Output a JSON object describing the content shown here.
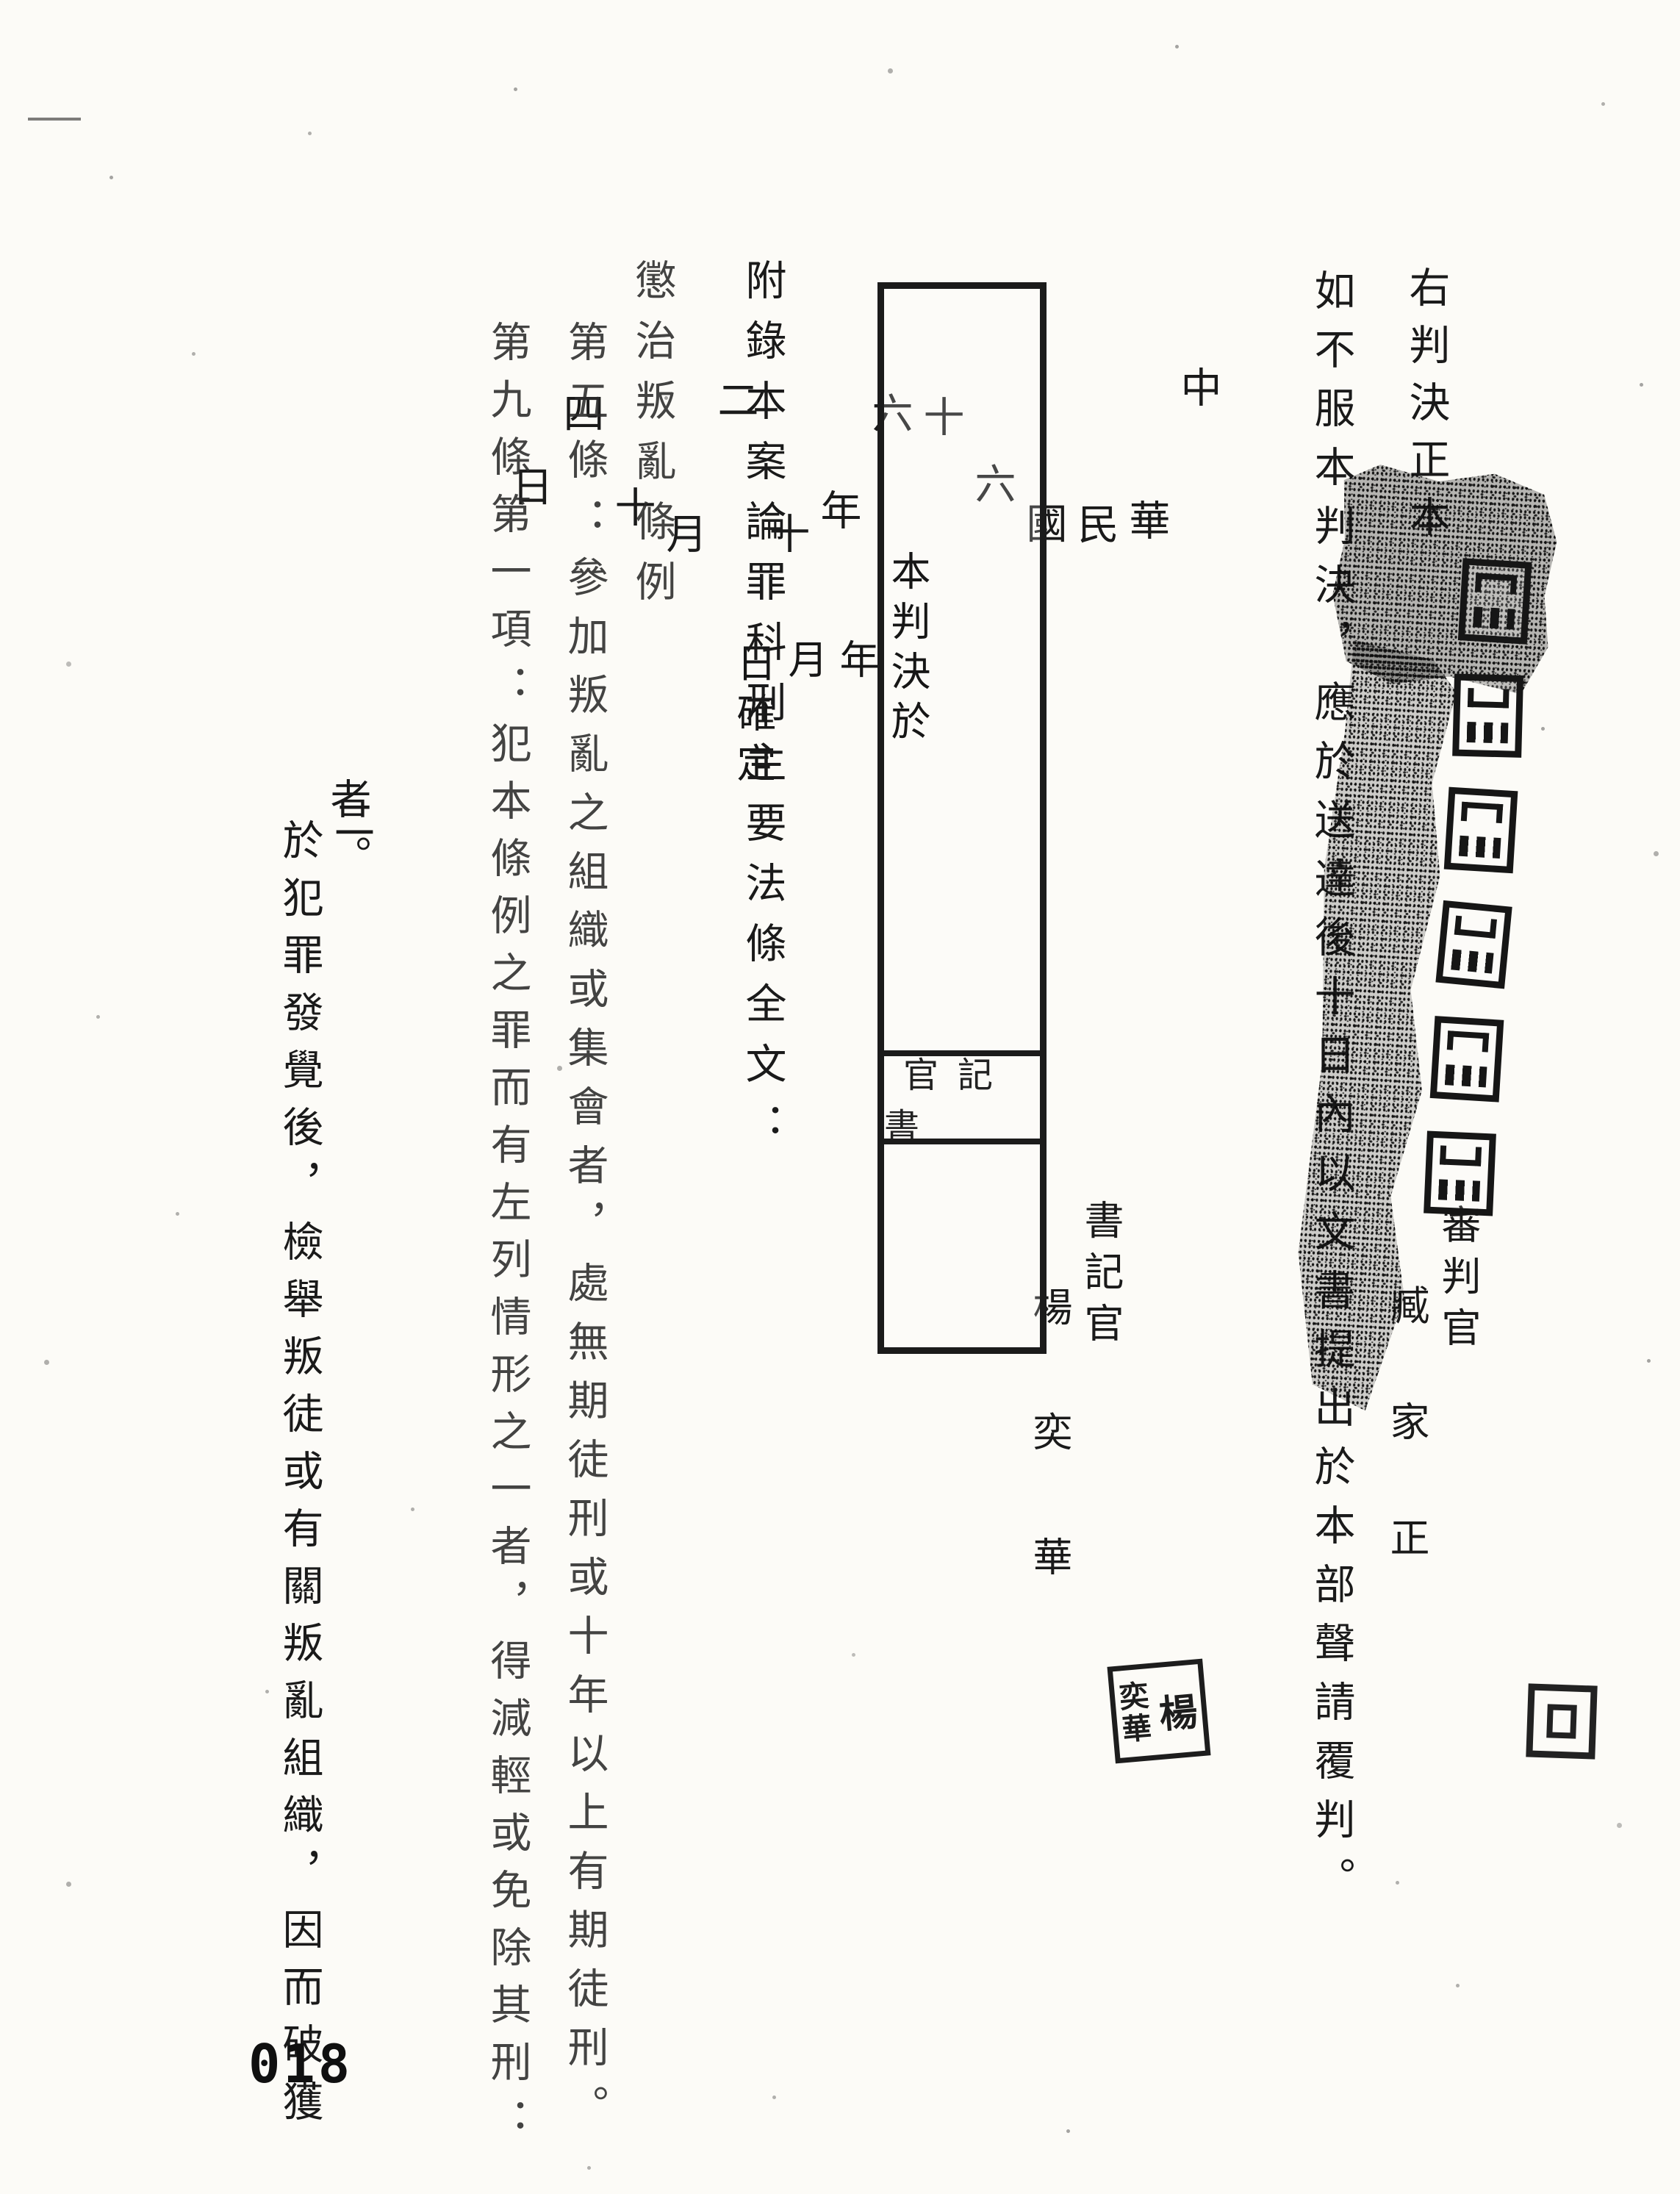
{
  "page": {
    "number": "018"
  },
  "closing": {
    "copy_note": "右判決正本",
    "appeal_notice": "如不服本判決，應於送達後十日內以文書提出於本部聲請覆判。",
    "date": {
      "parts": [
        "中",
        "華",
        "民",
        "國",
        "六",
        "十",
        "六",
        "年",
        "十",
        "二",
        "月",
        "十",
        "四",
        "日"
      ]
    },
    "judge": {
      "title": "審判官",
      "name": "臧家正"
    },
    "clerk": {
      "title": "書記官",
      "name": "楊奕華",
      "seal": {
        "right": "楊",
        "left_top": "奕",
        "left_bottom": "華"
      }
    }
  },
  "finality_box": {
    "line": {
      "prefix": "本判決於",
      "year": "年",
      "month": "月",
      "suffix": "日確定"
    },
    "clerk_label_rtl": "官記書"
  },
  "appendix": {
    "heading": "附錄本案論罪科刑主要法條全文：",
    "statute_title": "懲治叛亂條例",
    "article5": "第五條：參加叛亂之組織或集會者，處無期徒刑或十年以上有期徒刑。",
    "article9_intro": "第九條第一項：犯本條例之罪而有左列情形之一者，得減輕或免除其刑：",
    "item2": {
      "marker": "二",
      "text": "於犯罪發覺後，檢舉叛徒或有關叛亂組織，因而破獲",
      "continuation": "者。"
    }
  }
}
